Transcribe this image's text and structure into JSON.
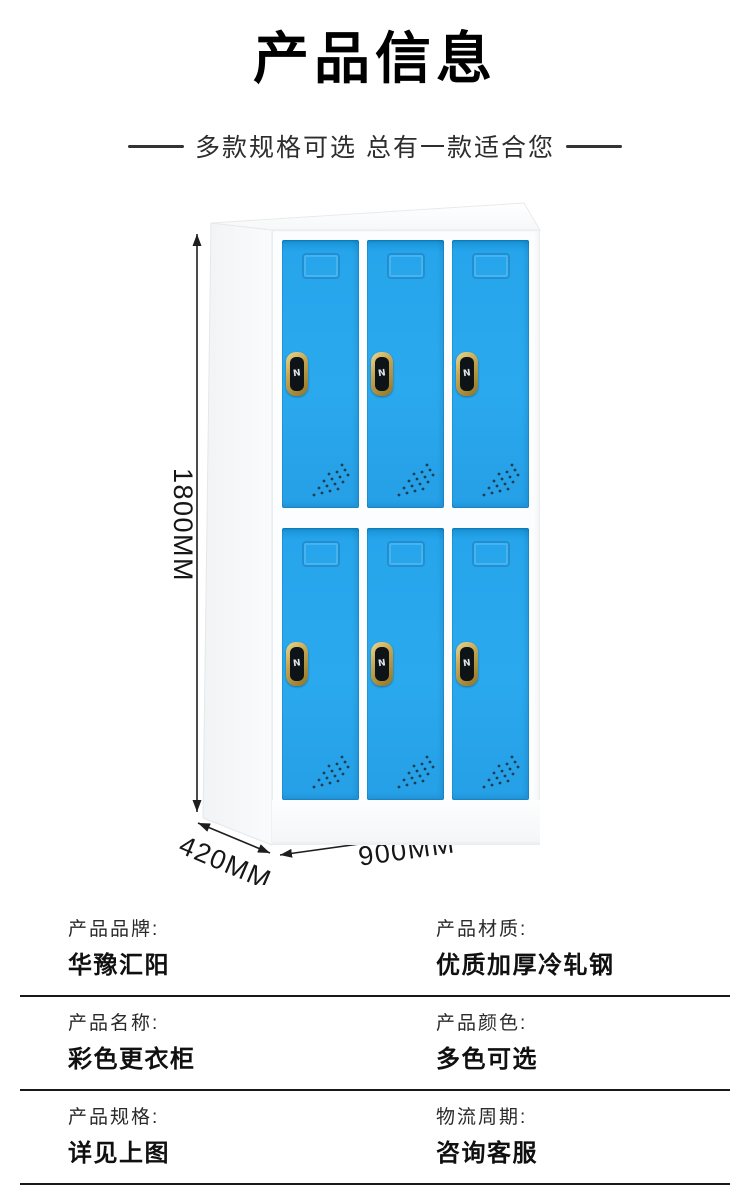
{
  "header": {
    "title": "产品信息",
    "subtitle": "多款规格可选 总有一款适合您"
  },
  "figure": {
    "doors": {
      "rows": 2,
      "columns": 3
    },
    "colors": {
      "door_blue": "#29A7EC",
      "cabinet_white": "#FCFDFE",
      "dimension_line": "#1E1E1E"
    },
    "dimensions": {
      "height": "1800MM",
      "depth": "420MM",
      "width": "900MM"
    }
  },
  "specs": [
    {
      "label": "产品品牌:",
      "value": "华豫汇阳"
    },
    {
      "label": "产品材质:",
      "value": "优质加厚冷轧钢"
    },
    {
      "label": "产品名称:",
      "value": "彩色更衣柜"
    },
    {
      "label": "产品颜色:",
      "value": "多色可选"
    },
    {
      "label": "产品规格:",
      "value": "详见上图"
    },
    {
      "label": "物流周期:",
      "value": "咨询客服"
    }
  ]
}
